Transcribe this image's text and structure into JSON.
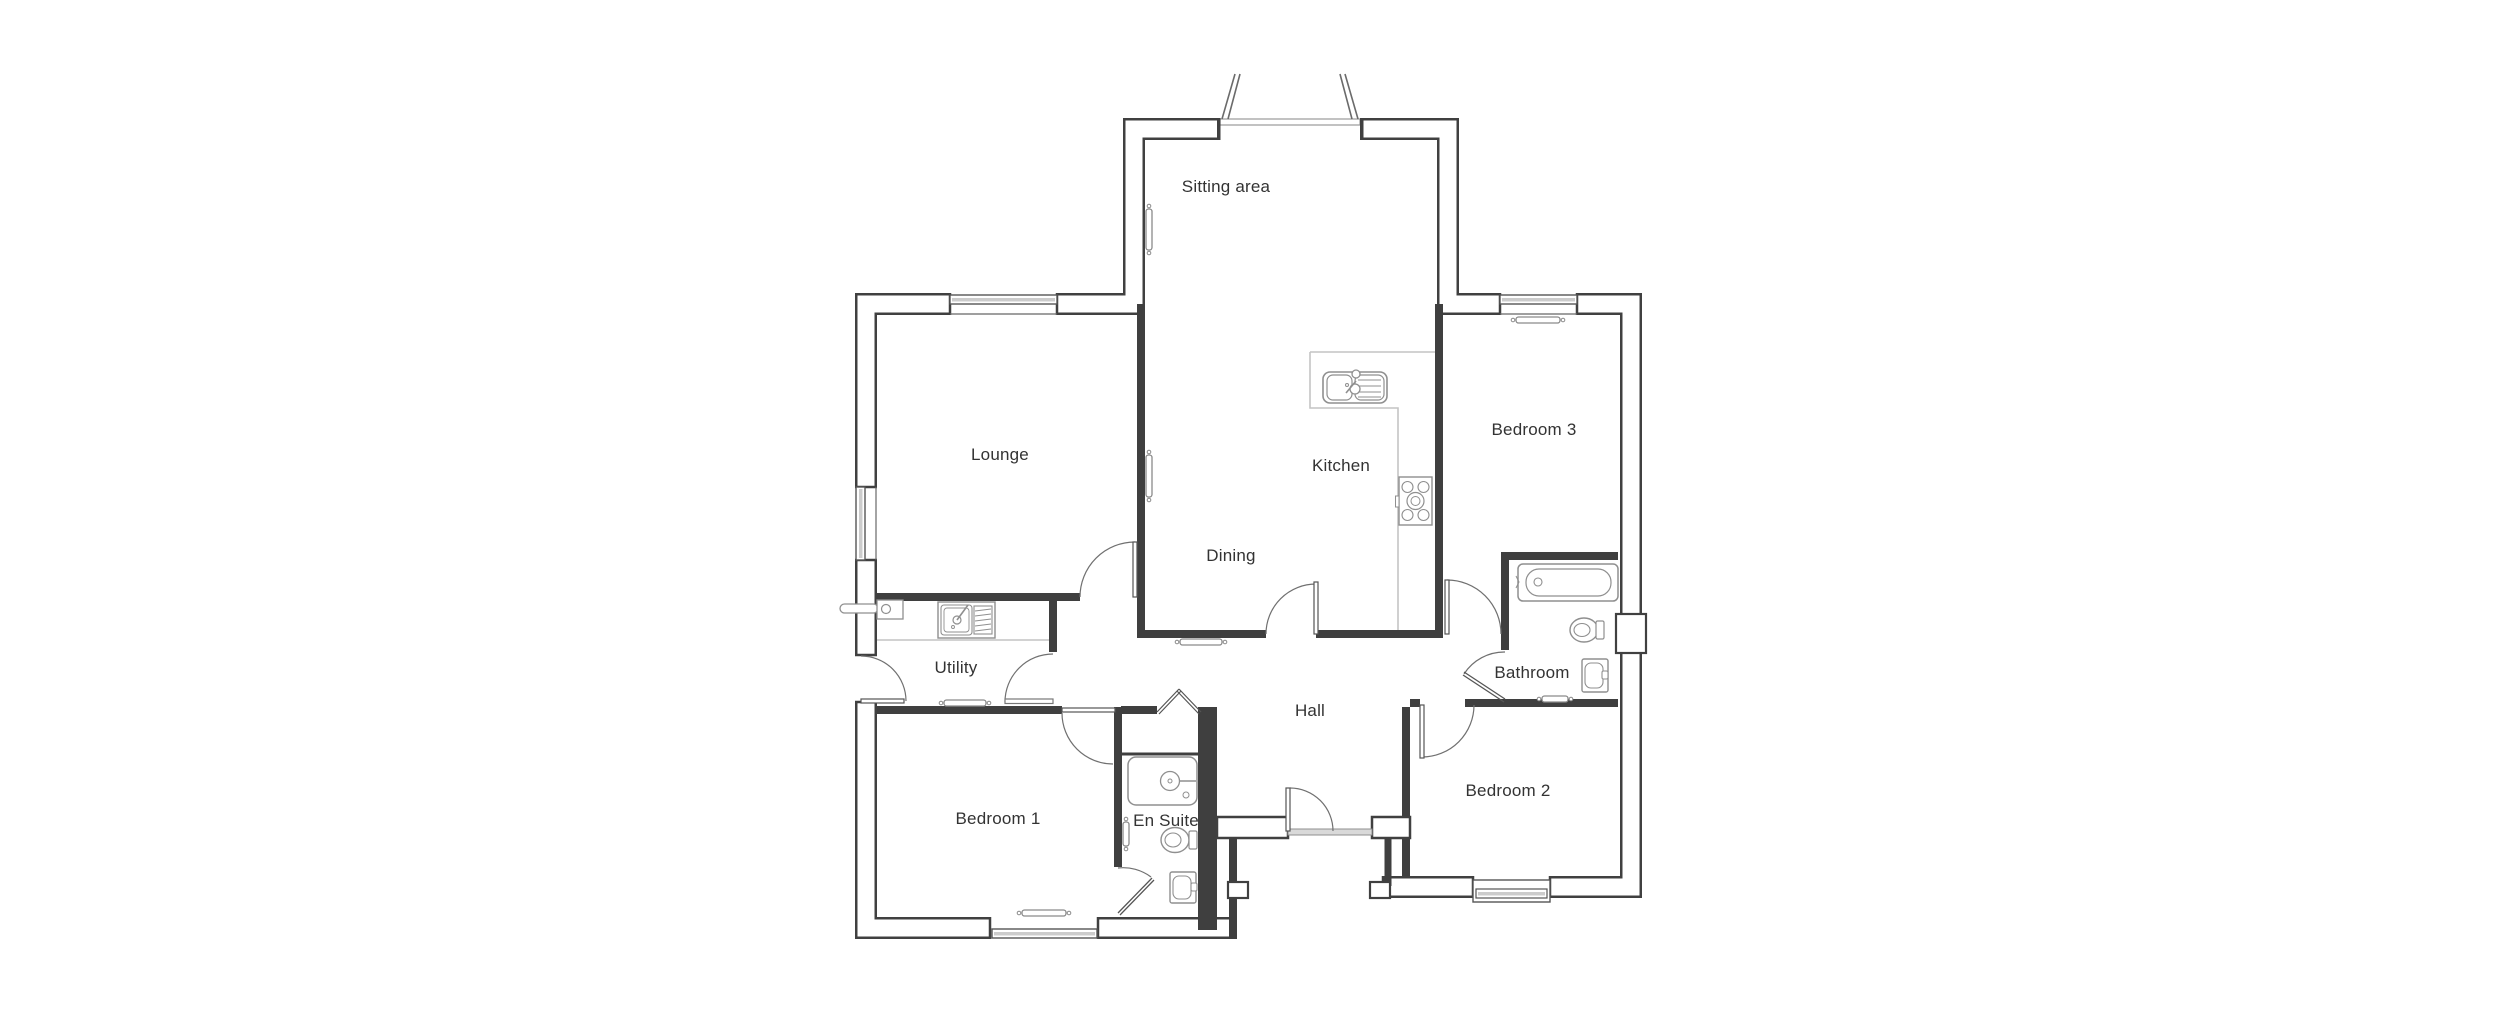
{
  "document": {
    "type": "floor-plan",
    "background": "#ffffff"
  },
  "rooms": [
    {
      "label": "Sitting area",
      "x": 1226,
      "y": 187
    },
    {
      "label": "Lounge",
      "x": 1000,
      "y": 455
    },
    {
      "label": "Kitchen",
      "x": 1341,
      "y": 466
    },
    {
      "label": "Dining",
      "x": 1231,
      "y": 556
    },
    {
      "label": "Bedroom 3",
      "x": 1534,
      "y": 430
    },
    {
      "label": "Utility",
      "x": 956,
      "y": 668
    },
    {
      "label": "Bathroom",
      "x": 1532,
      "y": 673
    },
    {
      "label": "Hall",
      "x": 1310,
      "y": 711
    },
    {
      "label": "Bedroom 1",
      "x": 998,
      "y": 819
    },
    {
      "label": "En Suite",
      "x": 1166,
      "y": 821
    },
    {
      "label": "Bedroom 2",
      "x": 1508,
      "y": 791
    }
  ],
  "fixtures": [
    "bath-icon",
    "toilet-icon",
    "basin-icon",
    "shower-icon",
    "kitchen-sink-icon",
    "hob-icon",
    "utility-sink-icon",
    "boiler-icon",
    "radiator-icon",
    "window-icon",
    "door-swing-icon",
    "french-doors-icon",
    "bifold-door-icon",
    "worktop-outline"
  ],
  "colors": {
    "wall": "#404040",
    "fixture": "#8f8f8f",
    "counter": "#c4c4c4",
    "radiator": "#8a8a8a",
    "glass": "#cccccc",
    "label": "#333333",
    "background": "#ffffff"
  }
}
